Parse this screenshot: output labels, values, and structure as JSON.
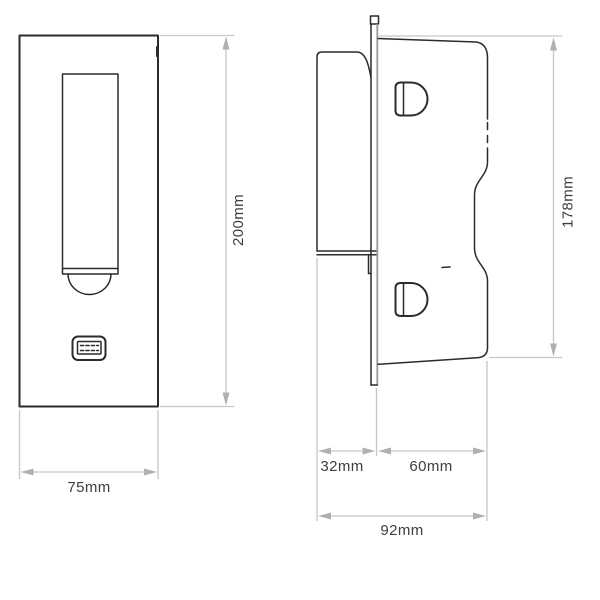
{
  "colors": {
    "outline": "#2b2b2b",
    "dimension_line": "#c7c7c7",
    "arrow": "#b0b0b0",
    "label_text": "#3d3d3d",
    "faceplate_edge_light": "#9a9a9a",
    "background": "#ffffff"
  },
  "drawing": {
    "front_view": {
      "height_label": "200mm",
      "width_label": "75mm"
    },
    "side_view": {
      "height_label": "178mm",
      "protrusion_label": "32mm",
      "recess_label": "60mm",
      "depth_label": "92mm"
    },
    "icons": {
      "usb_port": "usb-a-receptacle"
    }
  }
}
